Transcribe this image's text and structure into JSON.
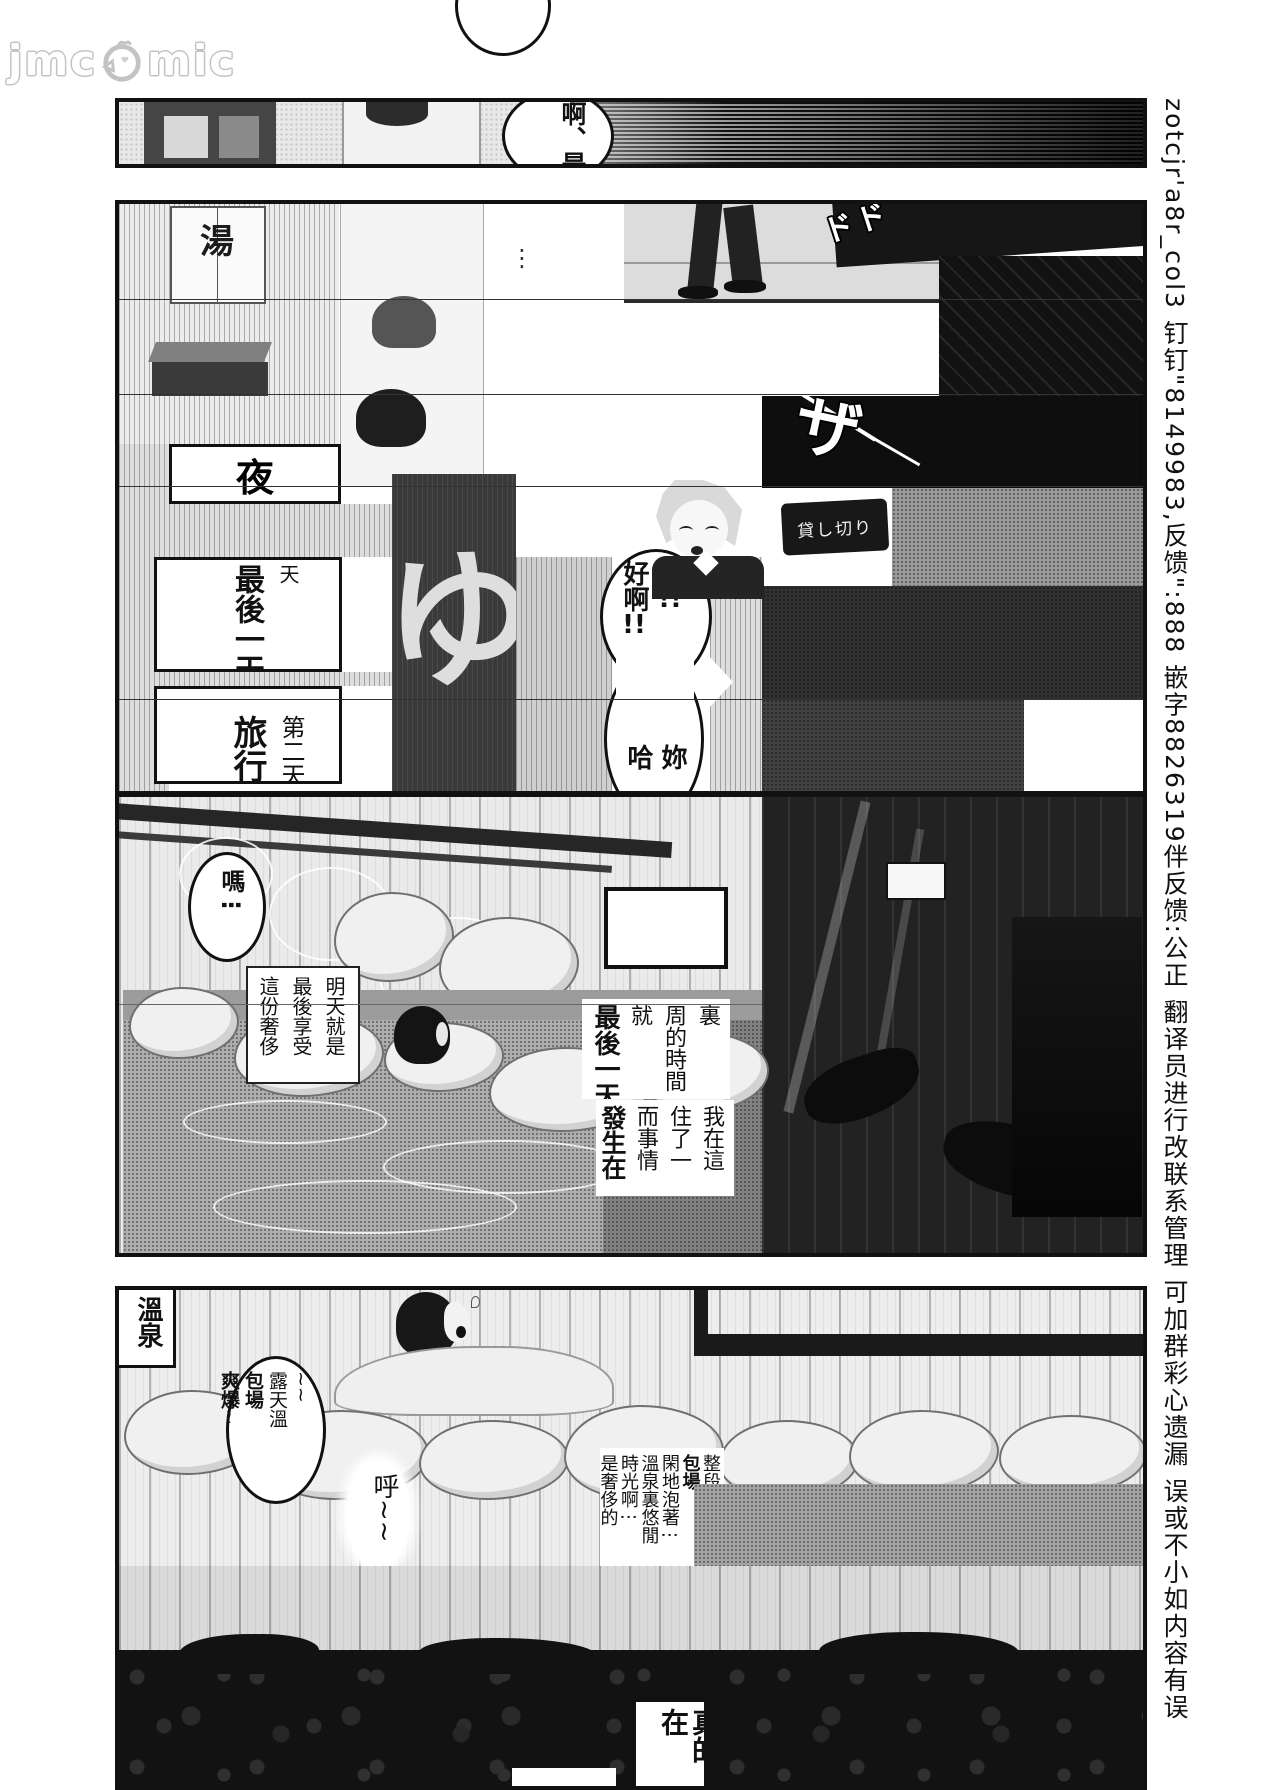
{
  "watermark": {
    "left": "jmc",
    "right": "mic"
  },
  "margin_credit": "zotcjr'a8r_col3 钉钉\"8149983,反馈\":888 嵌字8826319伴反馈:公正 翻译员进行改联系管理 可加群彩心遗漏 误或不小如内容有误",
  "p1": {
    "bubble": "啊、是"
  },
  "p2": {
    "noren": "湯",
    "sfx_top": "ドド",
    "sfx_mid": "ザ",
    "cap_night": "夜",
    "cap_day": "天",
    "cap_last": "最後一天",
    "cap_day2": "第二天",
    "cap_trip": "旅行",
    "dots": "⋮",
    "bath_mark": "ゆ",
    "bub_ha": "哈",
    "bub_ha_ex": "!!",
    "bub_good": "好啊",
    "bub_good_ex": "!!",
    "bub_ni": "妳",
    "bub_ha2": "哈",
    "door_sign": "貸し切り"
  },
  "p3": {
    "bub_ma": "嗎⋮",
    "cap_tomorrow": [
      "明天就是",
      "最後享受",
      "這份奢侈"
    ],
    "cap_week": [
      "裏",
      "周的時間⋮",
      "就",
      "最後一天"
    ],
    "cap_stay": [
      "我在這",
      "住了一",
      "而事情",
      "發生在"
    ]
  },
  "p4": {
    "corner": "溫泉",
    "bub_outdoor": [
      "~~",
      "露天溫",
      "包場",
      "爽爆~"
    ],
    "sigh": "呼~~",
    "cap_private": [
      "整段時間",
      "包場",
      "閑地泡著⋮",
      "溫泉裏悠閒",
      "時光啊⋮",
      "是奢侈的"
    ],
    "cap_really": "真的在"
  }
}
